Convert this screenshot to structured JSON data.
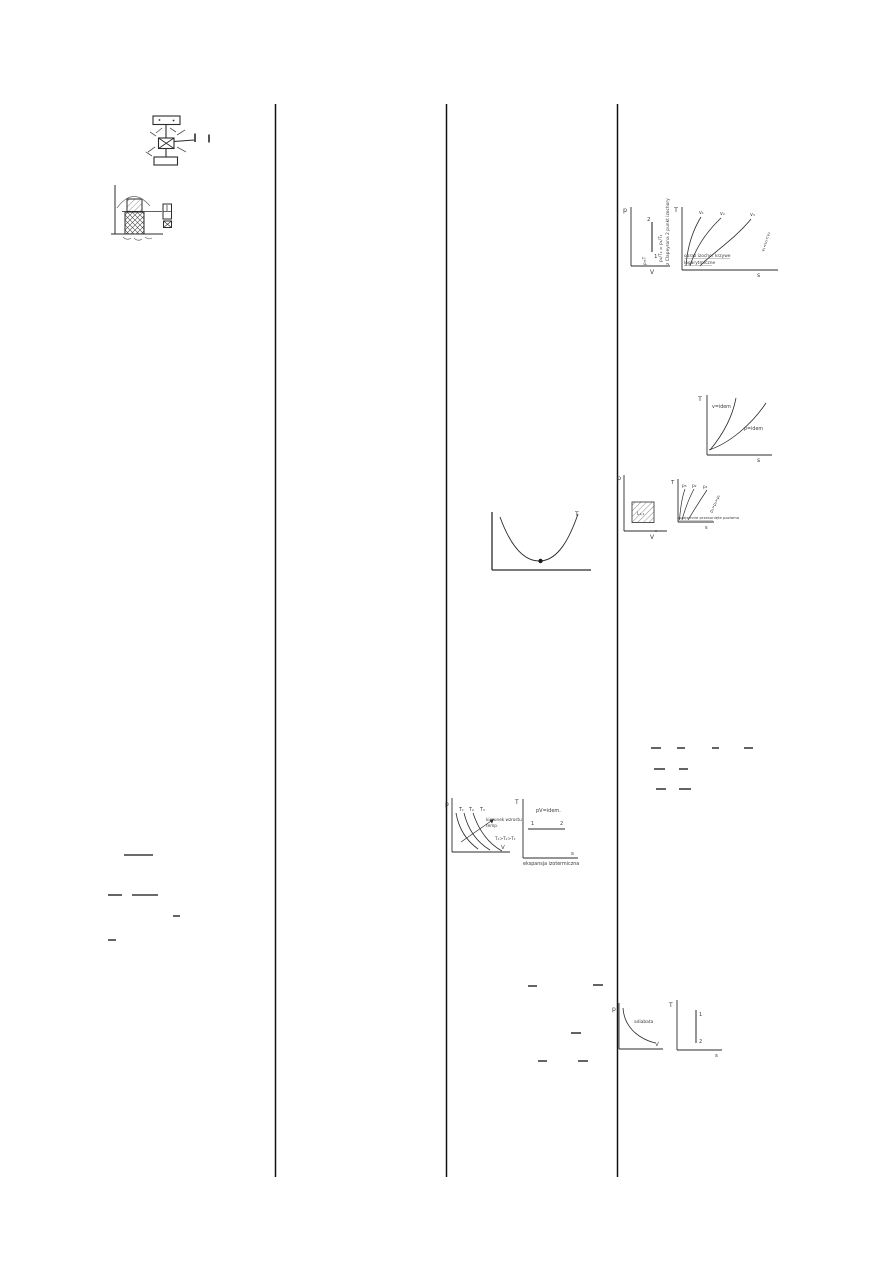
{
  "page": {
    "background": "#ffffff",
    "ink": "#2b2b2b",
    "type": "scanned handwritten thermodynamics notes, 4-column table fragment"
  },
  "diagrams": {
    "isochore_pv": {
      "axis_y": "p",
      "axis_x": "V",
      "state_top": "2",
      "state_bottom": "1",
      "note_rotated": "z Clapeyrona 2 punkt izochory",
      "equation_rotated": "p₂/T₂ = p₁/T₁",
      "relation_rotated": "p∝T"
    },
    "isochore_ts": {
      "axis_y": "T",
      "axis_x": "s",
      "curves": [
        "v₁",
        "v₂",
        "v₃"
      ],
      "order_note": "v₁<v₂<v₃",
      "caption1": "obraz izochor krzywe",
      "caption2": "logarytmiczne"
    },
    "iso_compare_ts": {
      "axis_y": "T",
      "axis_x": "s",
      "steep_label": "v=idem",
      "flat_label": "p=idem"
    },
    "work_pv": {
      "axis_y": "p",
      "axis_x": "V",
      "area_label": "L₁,₂"
    },
    "isobar_ts": {
      "axis_y": "T",
      "axis_x": "s",
      "curves": [
        "p₃",
        "p₂",
        "p₁"
      ],
      "order_note": "p₃>p₂>p₁",
      "caption": "wzajemnie przesunięte poziomo"
    },
    "u_curve": {
      "end_label": "T"
    },
    "isotherm_pv": {
      "axis_y": "p",
      "axis_x": "V",
      "curves": [
        "T₁",
        "T₂",
        "T₃"
      ],
      "arrow_note1": "kierunek wzrostu",
      "arrow_note2": "temp.",
      "order_note": "T₃>T₂>T₁"
    },
    "isotherm_ts": {
      "axis_y": "T",
      "axis_x": "s",
      "title": "pV=idem.",
      "point_left": "1",
      "point_right": "2",
      "caption": "ekspansja izotermiczna"
    },
    "adiabat_pv": {
      "axis_y": "p",
      "axis_x": "V",
      "curve_label": "adiabata"
    },
    "adiabat_ts": {
      "axis_y": "T",
      "axis_x": "s",
      "point_top": "1",
      "point_bottom": "2"
    }
  }
}
